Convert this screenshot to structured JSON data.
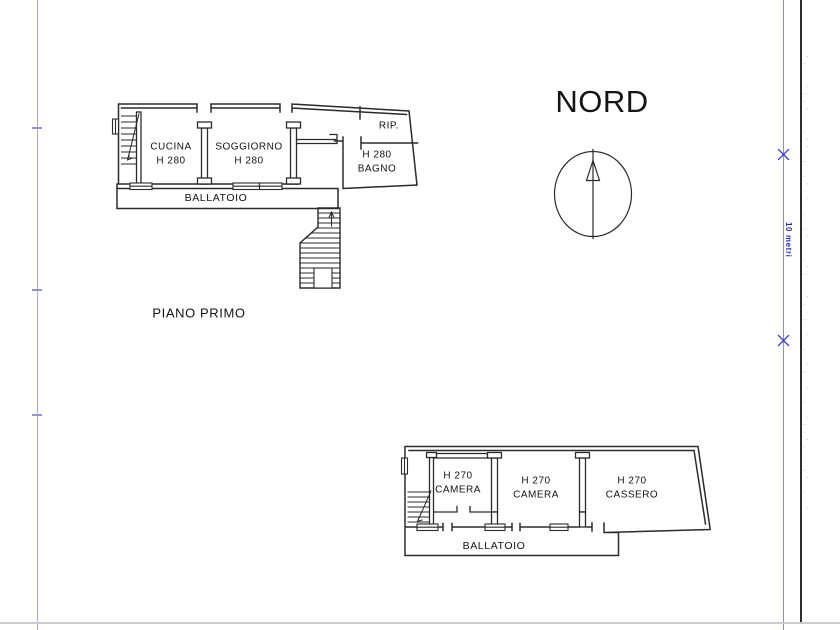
{
  "page": {
    "north_label": "NORD",
    "scale_label": "10 metri",
    "edge_stamp": "' , . ` ' ; , ' . ` , ' ' . ; ` , ' . ' ` , . ; ' ` . , ' ; ` . ' , ` ; . ' ` , . ' ; ` ' . , ` ' ; . ' , ` . ; ' ` , . '",
    "colors": {
      "plan_line": "#2b2b2b",
      "scale_blue": "#2a2ac4",
      "guide_blue": "#8a8ad6",
      "frame_black": "#2d2d2d",
      "page_edge_gray": "#cccccc"
    }
  },
  "plans": [
    {
      "title": "PIANO PRIMO",
      "rooms": [
        {
          "line1": "CUCINA",
          "line2": "H 280"
        },
        {
          "line1": "SOGGIORNO",
          "line2": "H 280"
        },
        {
          "line1": "RIP."
        },
        {
          "line1": "H 280",
          "line2": "BAGNO"
        }
      ],
      "walkway": "BALLATOIO"
    },
    {
      "rooms": [
        {
          "line1": "H 270",
          "line2": "CAMERA"
        },
        {
          "line1": "H 270",
          "line2": "CAMERA"
        },
        {
          "line1": "H 270",
          "line2": "CASSERO"
        }
      ],
      "walkway": "BALLATOIO"
    }
  ]
}
